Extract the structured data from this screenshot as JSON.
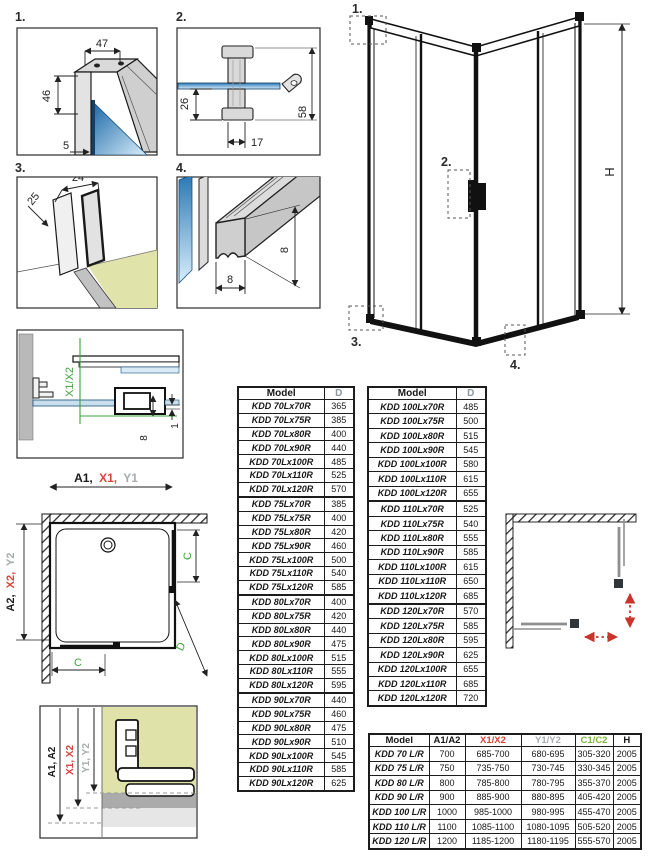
{
  "colors": {
    "accent_red": "#d8433c",
    "accent_green": "#3da43a",
    "header_green": "#7cb54a",
    "accent_gray": "#a8acae",
    "d_header_gray": "#8d989f",
    "glass_blue_dark": "#2a78b5",
    "glass_blue_light": "#d9eefb",
    "floor_olive": "#dfe3a9",
    "arrow_red": "#c9342b"
  },
  "panels": {
    "p1": {
      "label": "1.",
      "dim_top": "47",
      "dim_left": "46",
      "dim_bottom": "5"
    },
    "p2": {
      "label": "2.",
      "dim_left": "26",
      "dim_bottom": "17",
      "dim_right": "58"
    },
    "p3": {
      "label": "3.",
      "dim_diag": "25",
      "dim_top": "24"
    },
    "p4": {
      "label": "4.",
      "dim_right": "8",
      "dim_bottom": "8"
    }
  },
  "enclosure": {
    "callout_1": "1.",
    "callout_2": "2.",
    "callout_3": "3.",
    "callout_4": "4.",
    "height_label": "H"
  },
  "section_detail": {
    "xline_label": "X1/X2",
    "dim_glass": "8",
    "dim_gap": "1"
  },
  "width_span": {
    "a": "A1,",
    "x": "X1,",
    "y": "Y1"
  },
  "plan_view": {
    "a": "A2,",
    "x": "X2,",
    "y": "Y2",
    "c_right": "C",
    "c_bottom": "C",
    "d": "D"
  },
  "adjust_detail": {
    "a": "A1, A2",
    "x": "X1, X2",
    "y": "Y1, Y2"
  },
  "tables": {
    "d_left": {
      "headers": [
        "Model",
        "D"
      ],
      "rows": [
        [
          "KDD 70Lx70R",
          "365"
        ],
        [
          "KDD 70Lx75R",
          "385"
        ],
        [
          "KDD 70Lx80R",
          "400"
        ],
        [
          "KDD 70Lx90R",
          "440"
        ],
        [
          "KDD 70Lx100R",
          "485"
        ],
        [
          "KDD 70Lx110R",
          "525"
        ],
        [
          "KDD 70Lx120R",
          "570"
        ],
        [
          "KDD 75Lx70R",
          "385"
        ],
        [
          "KDD 75Lx75R",
          "400"
        ],
        [
          "KDD 75Lx80R",
          "420"
        ],
        [
          "KDD 75Lx90R",
          "460"
        ],
        [
          "KDD 75Lx100R",
          "500"
        ],
        [
          "KDD 75Lx110R",
          "540"
        ],
        [
          "KDD 75Lx120R",
          "585"
        ],
        [
          "KDD 80Lx70R",
          "400"
        ],
        [
          "KDD 80Lx75R",
          "420"
        ],
        [
          "KDD 80Lx80R",
          "440"
        ],
        [
          "KDD 80Lx90R",
          "475"
        ],
        [
          "KDD 80Lx100R",
          "515"
        ],
        [
          "KDD 80Lx110R",
          "555"
        ],
        [
          "KDD 80Lx120R",
          "595"
        ],
        [
          "KDD 90Lx70R",
          "440"
        ],
        [
          "KDD 90Lx75R",
          "460"
        ],
        [
          "KDD 90Lx80R",
          "475"
        ],
        [
          "KDD 90Lx90R",
          "510"
        ],
        [
          "KDD 90Lx100R",
          "545"
        ],
        [
          "KDD 90Lx110R",
          "585"
        ],
        [
          "KDD 90Lx120R",
          "625"
        ]
      ]
    },
    "d_right": {
      "headers": [
        "Model",
        "D"
      ],
      "rows": [
        [
          "KDD 100Lx70R",
          "485"
        ],
        [
          "KDD 100Lx75R",
          "500"
        ],
        [
          "KDD 100Lx80R",
          "515"
        ],
        [
          "KDD 100Lx90R",
          "545"
        ],
        [
          "KDD 100Lx100R",
          "580"
        ],
        [
          "KDD 100Lx110R",
          "615"
        ],
        [
          "KDD 100Lx120R",
          "655"
        ],
        [
          "KDD 110Lx70R",
          "525"
        ],
        [
          "KDD 110Lx75R",
          "540"
        ],
        [
          "KDD 110Lx80R",
          "555"
        ],
        [
          "KDD 110Lx90R",
          "585"
        ],
        [
          "KDD 110Lx100R",
          "615"
        ],
        [
          "KDD 110Lx110R",
          "650"
        ],
        [
          "KDD 110Lx120R",
          "685"
        ],
        [
          "KDD 120Lx70R",
          "570"
        ],
        [
          "KDD 120Lx75R",
          "585"
        ],
        [
          "KDD 120Lx80R",
          "595"
        ],
        [
          "KDD 120Lx90R",
          "625"
        ],
        [
          "KDD 120Lx100R",
          "655"
        ],
        [
          "KDD 120Lx110R",
          "685"
        ],
        [
          "KDD 120Lx120R",
          "720"
        ]
      ]
    },
    "main": {
      "headers": [
        "Model",
        "A1/A2",
        "X1/X2",
        "Y1/Y2",
        "C1/C2",
        "H"
      ],
      "rows": [
        [
          "KDD 70 L/R",
          "700",
          "685-700",
          "680-695",
          "305-320",
          "2005"
        ],
        [
          "KDD 75 L/R",
          "750",
          "735-750",
          "730-745",
          "330-345",
          "2005"
        ],
        [
          "KDD 80 L/R",
          "800",
          "785-800",
          "780-795",
          "355-370",
          "2005"
        ],
        [
          "KDD 90 L/R",
          "900",
          "885-900",
          "880-895",
          "405-420",
          "2005"
        ],
        [
          "KDD 100 L/R",
          "1000",
          "985-1000",
          "980-995",
          "455-470",
          "2005"
        ],
        [
          "KDD 110 L/R",
          "1100",
          "1085-1100",
          "1080-1095",
          "505-520",
          "2005"
        ],
        [
          "KDD 120 L/R",
          "1200",
          "1185-1200",
          "1180-1195",
          "555-570",
          "2005"
        ]
      ]
    }
  }
}
